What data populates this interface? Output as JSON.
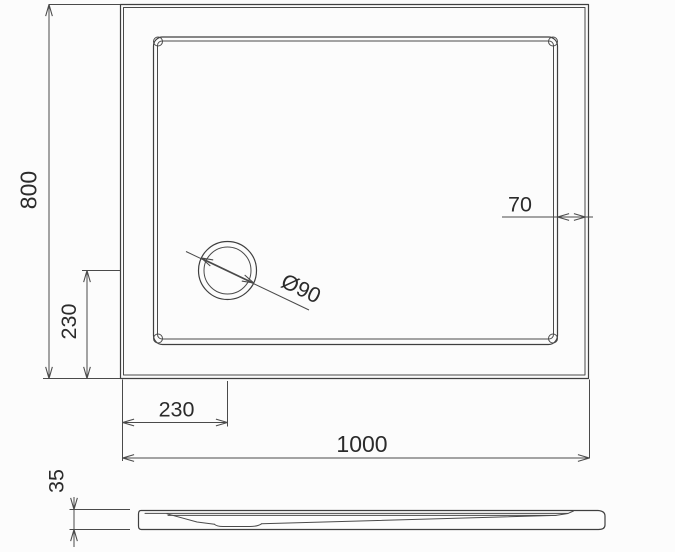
{
  "drawing": {
    "description": "Shower tray technical drawing, plan view and side profile",
    "labels": {
      "overall_width": "1000",
      "overall_depth": "800",
      "rim_offset": "70",
      "drain_diameter": "Ø90",
      "drain_offset_horizontal": "230",
      "drain_offset_vertical": "230",
      "tray_height": "35"
    },
    "colors": {
      "background": "#fcfcfc",
      "object_line": "#3f3f3f",
      "dimension_line": "#4a4a4a",
      "text": "#2b2b2b"
    }
  }
}
